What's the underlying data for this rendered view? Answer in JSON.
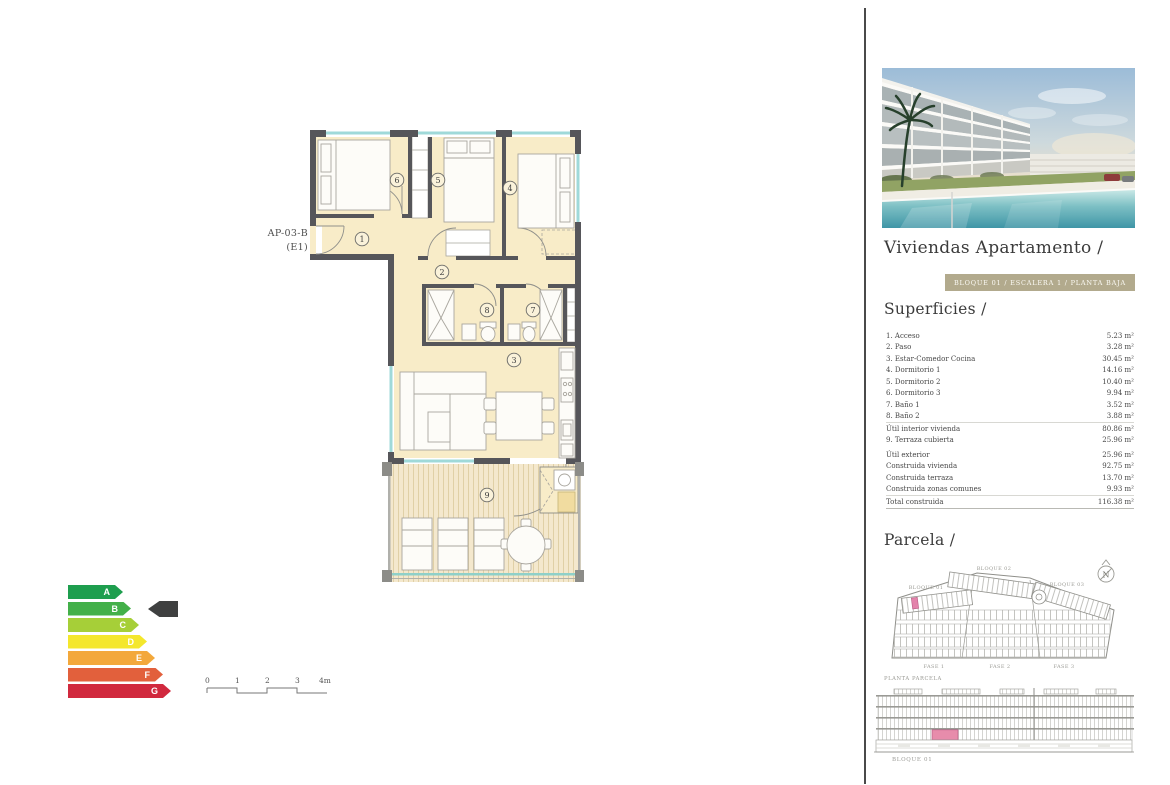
{
  "plan": {
    "unit_label": "AP-03-B",
    "unit_sublabel": "(E1)",
    "rooms": {
      "r1": "1",
      "r2": "2",
      "r3": "3",
      "r4": "4",
      "r5": "5",
      "r6": "6",
      "r7": "7",
      "r8": "8",
      "r9": "9"
    }
  },
  "energy": {
    "ratings": [
      {
        "letter": "A",
        "color": "#1e9e4e"
      },
      {
        "letter": "B",
        "color": "#43b049"
      },
      {
        "letter": "C",
        "color": "#a6cf38"
      },
      {
        "letter": "D",
        "color": "#f4e72c"
      },
      {
        "letter": "E",
        "color": "#f3a83b"
      },
      {
        "letter": "F",
        "color": "#e2603c"
      },
      {
        "letter": "G",
        "color": "#d1293e"
      }
    ],
    "selected": "B",
    "pointer_color": "#3f4040"
  },
  "scalebar": {
    "t0": "0",
    "t1": "1",
    "t2": "2",
    "t3": "3",
    "t4": "4m"
  },
  "right": {
    "title": "Viviendas Apartamento /",
    "badge": "BLOQUE 01 / ESCALERA 1 / PLANTA BAJA",
    "superficies": {
      "heading": "Superficies /",
      "rows": [
        {
          "label": "1. Acceso",
          "value": "5.23 m²"
        },
        {
          "label": "2. Paso",
          "value": "3.28 m²"
        },
        {
          "label": "3. Estar-Comedor Cocina",
          "value": "30.45 m²"
        },
        {
          "label": "4. Dormitorio 1",
          "value": "14.16 m²"
        },
        {
          "label": "5. Dormitorio 2",
          "value": "10.40 m²"
        },
        {
          "label": "6. Dormitorio 3",
          "value": "9.94 m²"
        },
        {
          "label": "7. Baño 1",
          "value": "3.52 m²"
        },
        {
          "label": "8. Baño 2",
          "value": "3.88 m²"
        },
        {
          "label": "Útil interior vivienda",
          "value": "80.86 m²"
        },
        {
          "label": "9. Terraza cubierta",
          "value": "25.96 m²"
        },
        {
          "label": "Útil exterior",
          "value": "25.96 m²"
        },
        {
          "label": "Construida vivienda",
          "value": "92.75 m²"
        },
        {
          "label": "Construida terraza",
          "value": "13.70 m²"
        },
        {
          "label": "Construida zonas comunes",
          "value": "9.93 m²"
        },
        {
          "label": "Total construida",
          "value": "116.38 m²"
        }
      ]
    },
    "parcela": {
      "heading": "Parcela /",
      "bloque1": "BLOQUE 01",
      "bloque2": "BLOQUE 02",
      "bloque3": "BLOQUE 03",
      "fase1": "FASE 1",
      "fase2": "FASE 2",
      "fase3": "FASE 3",
      "caption": "PLANTA PARCELA",
      "compass": "N"
    },
    "elevation": {
      "caption": "BLOQUE 01"
    }
  },
  "colors": {
    "highlight_pink": "#e383ab",
    "badge_bg": "#b2aa8d",
    "wall": "#56565a",
    "floor": "#f8ecc8",
    "window": "#9fd9d9",
    "divider": "#4a4a4a"
  }
}
